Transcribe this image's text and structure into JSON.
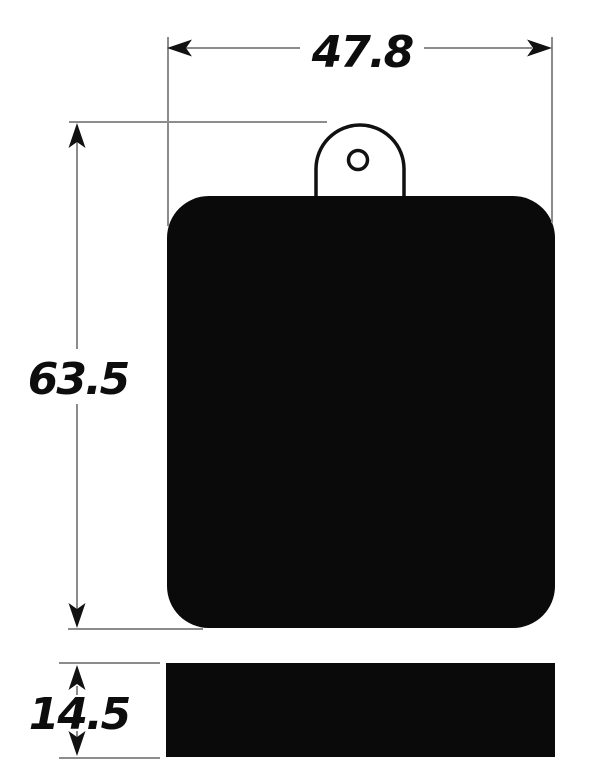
{
  "drawing": {
    "labels": {
      "width": "47.8",
      "height": "63.5",
      "thickness": "14.5"
    },
    "colors": {
      "shape_fill": "#0a0a0a",
      "outline": "#111111",
      "dimension_line": "#8c8c8c",
      "arrow_fill": "#111111",
      "background": "#ffffff"
    }
  }
}
